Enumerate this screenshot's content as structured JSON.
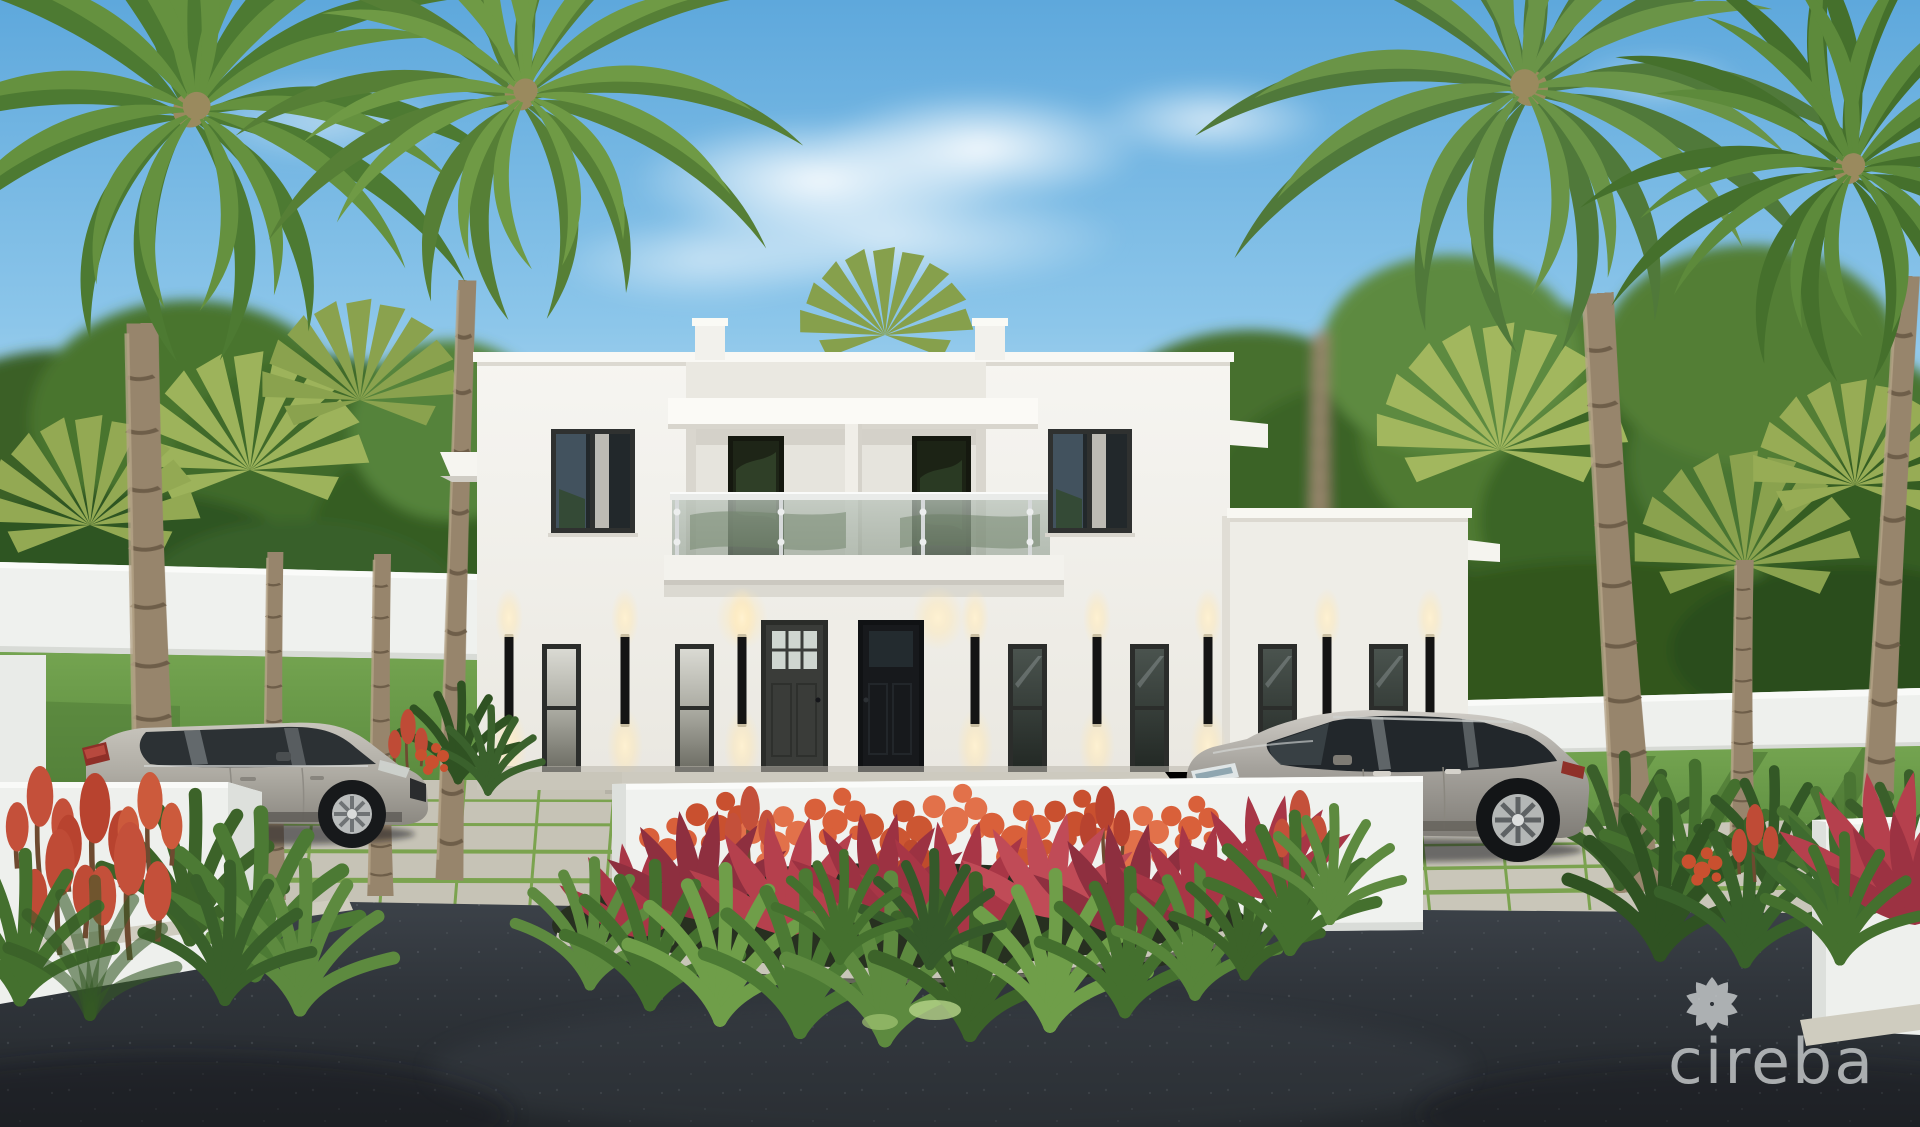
{
  "watermark": {
    "text": "cireba",
    "icon": "petal-ring-logo",
    "color": "#c9ccce"
  },
  "palette": {
    "sky_top": "#5ea8dc",
    "sky_horizon": "#e8f4fa",
    "facade_white": "#f2f1ec",
    "door_dark": "#17191c",
    "foliage_green": "#4d7a32",
    "flower_red": "#c4503a",
    "flower_orange": "#d9603a",
    "lawn_green": "#6a9a48",
    "paver_grey": "#c6c3b6",
    "asphalt_dark": "#2c3134",
    "vehicle_silver": "#b3b0a8"
  },
  "scene": {
    "description": "Rendering of a modern two-storey white duplex villa with a glass-railed balcony, black wall sconces, two dark entry doors, tropical palm trees, a flowering garden island, paver parking aprons and two silver SUVs on an asphalt driveway",
    "house": {
      "storeys": 2,
      "entry_doors": 2,
      "balcony_doors": 2,
      "upper_windows": 2,
      "ground_windows": 6,
      "wall_sconces": 8
    },
    "vehicles": [
      {
        "type": "compact-suv",
        "color": "silver",
        "position": "left"
      },
      {
        "type": "luxury-suv",
        "color": "silver",
        "position": "right"
      }
    ],
    "landscape": {
      "palms": "feather and fan palms",
      "garden_island": "red ti plants, orange ixora, green spike grass",
      "perimeter": "white privacy walls"
    }
  }
}
